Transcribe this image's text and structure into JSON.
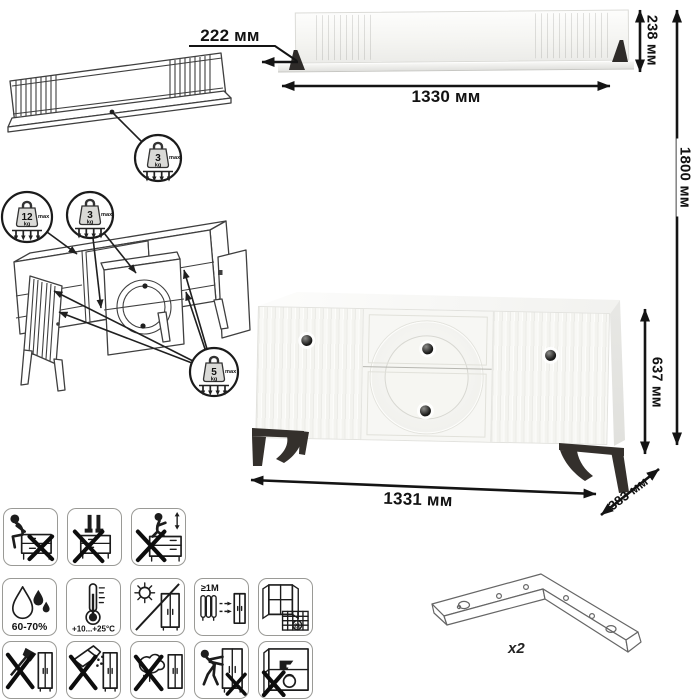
{
  "dimensions": {
    "shelf_depth": "222 мм",
    "shelf_width": "1330 мм",
    "shelf_height": "238 мм",
    "total_height": "1800 мм",
    "cabinet_height": "637 мм",
    "cabinet_width": "1331 мм",
    "cabinet_depth": "383 мм"
  },
  "weight_limits": {
    "shelf": {
      "value": "3",
      "unit": "kg",
      "qualifier": "max"
    },
    "cabinet_top": {
      "value": "12",
      "unit": "kg",
      "qualifier": "max"
    },
    "drawers": {
      "value": "3",
      "unit": "kg",
      "qualifier": "max"
    },
    "shelves": {
      "value": "5",
      "unit": "kg",
      "qualifier": "max"
    }
  },
  "care": {
    "humidity": "60-70%",
    "temperature": "+10...+25°C",
    "heat_distance": "≥1M",
    "calendar_day": "21"
  },
  "parts": {
    "bracket_quantity": "x2"
  },
  "colors": {
    "line": "#1c1c1c",
    "furniture_white": "#f7f7f4",
    "leg_dark": "#34302c"
  }
}
